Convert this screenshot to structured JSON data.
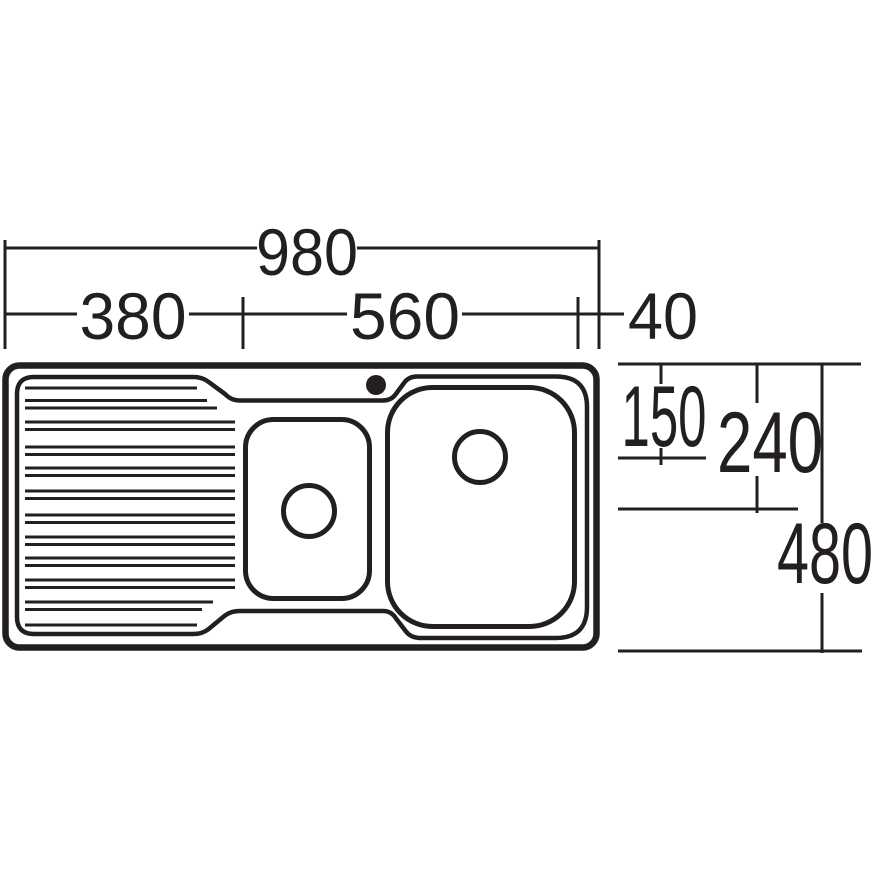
{
  "diagram": {
    "title": "Kitchen sink technical drawing - top view with drainer, one-and-a-quarter bowls and tap hole",
    "top_dimensions": {
      "overall_width": "980",
      "drainer_width": "380",
      "bowl_section_width": "560",
      "right_edge_offset": "40"
    },
    "side_dimensions": {
      "large_bowl_drain_offset": "150",
      "small_bowl_drain_offset": "240",
      "overall_depth": "480"
    },
    "colors": {
      "line": "#231f20",
      "large_bowl_fill": "#a6ce3b",
      "small_bowl_fill": "#e7eed2",
      "background": "#ffffff"
    }
  }
}
